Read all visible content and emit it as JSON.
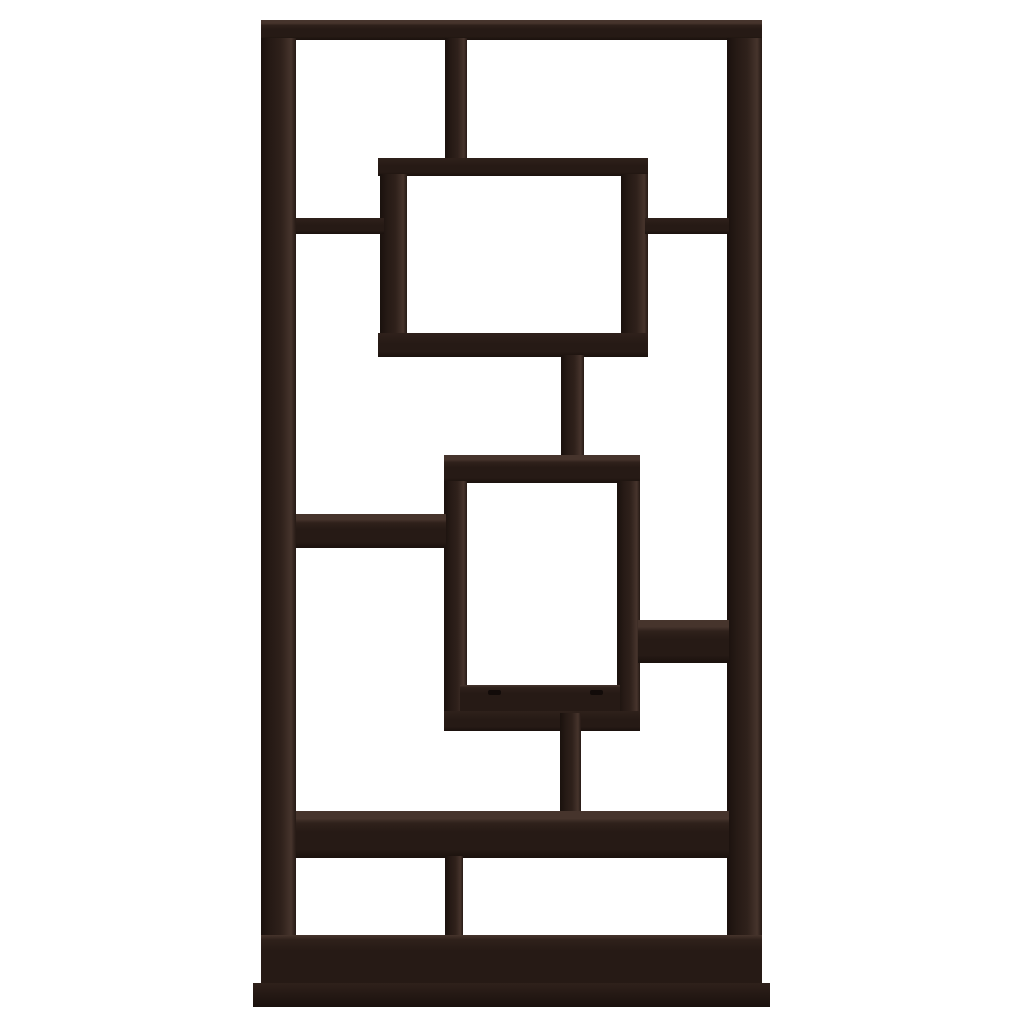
{
  "meta": {
    "description": "Product photo of a dark espresso brown asymmetrical geometric cube bookcase with interlocking rectangular shelves, shown front-on against a plain white background",
    "subject": "geometric-10-shelf-bookcase"
  },
  "colors": {
    "bg": "#ffffff",
    "wood-darkest": "#120b09",
    "wood-edge": "#1a110d",
    "wood-front": "#261a15",
    "wood-mid": "#2f211b",
    "wood-top": "#46342c"
  },
  "bookcase": {
    "parts": [
      "top-panel",
      "left-side-panel",
      "right-side-panel",
      "upper-divider",
      "floating-cube-upper",
      "upper-shelf-left",
      "upper-shelf-right",
      "connector-stem-upper",
      "floating-cube-lower",
      "middle-shelf-left",
      "middle-shelf-right",
      "connector-stem-lower",
      "wide-shelf",
      "lower-divider",
      "bottom-deck",
      "base-plinth"
    ]
  }
}
